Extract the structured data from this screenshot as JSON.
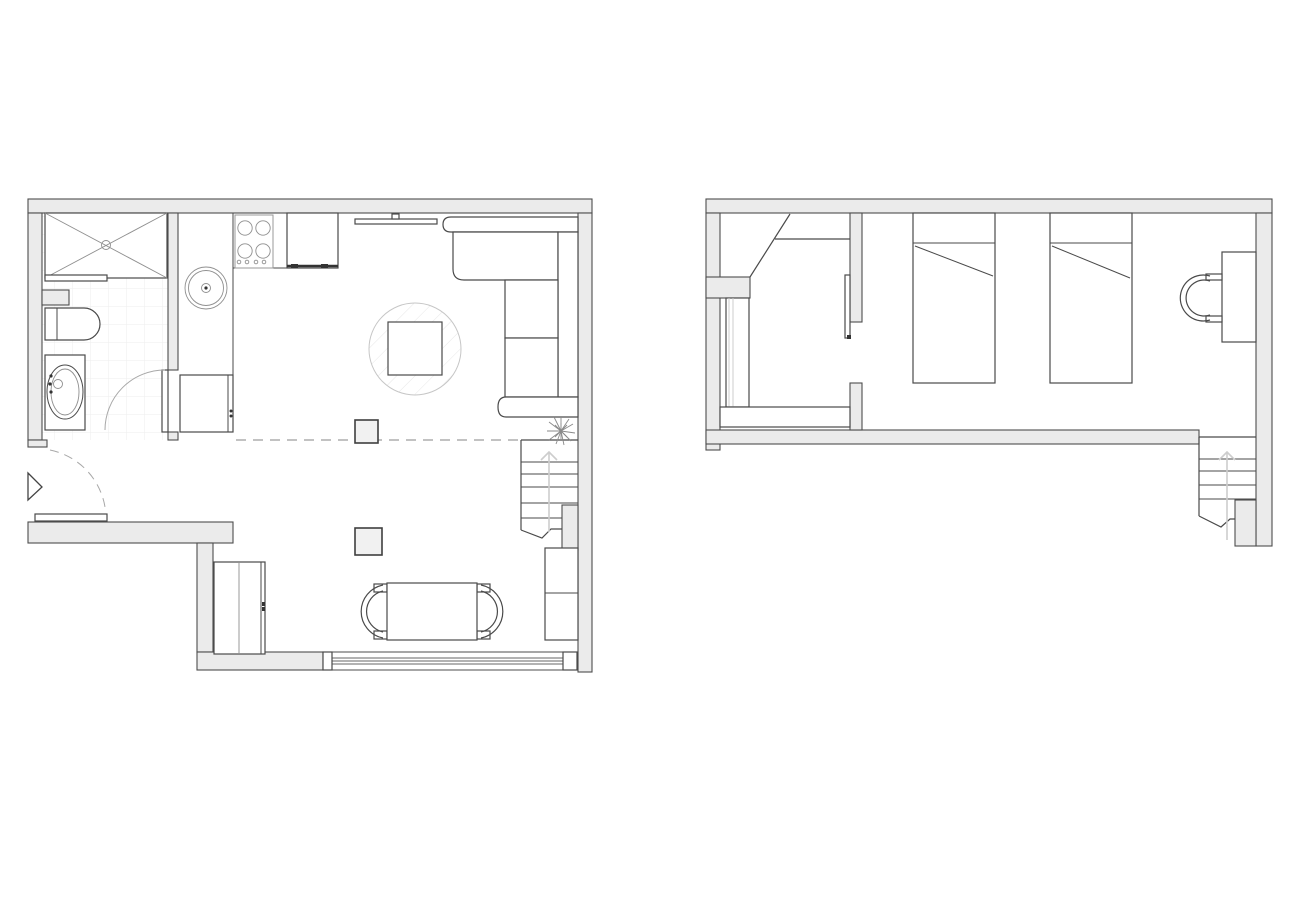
{
  "image": {
    "description": "Black-and-white architectural floor plan of a two-level apartment: ground floor with bathroom, kitchen, living and dining areas on the left; upper floor with closet room and twin bedroom on the right",
    "background": "#ffffff"
  },
  "colors": {
    "wall_fill": "#ebebeb",
    "wall_line": "#4d4d4d",
    "furn_line": "#4a4a4a",
    "light_line": "#8f8f8f",
    "faint_line": "#c9c9c9",
    "dash_line": "#c2c2c2",
    "arrow_line": "#cdcdcd",
    "column_fill": "#f1f1f1",
    "tile_line": "#ededed",
    "hatch_line": "#e7e7e7",
    "bg": "#ffffff"
  },
  "plans": [
    {
      "id": "ground-floor",
      "position": "left",
      "rooms": [
        {
          "name": "bathroom",
          "furniture": [
            "shower-tray-with-cross",
            "shower-screen",
            "toilet",
            "washbasin-vanity",
            "hinged-door-with-swing-arc",
            "tiled-floor"
          ]
        },
        {
          "name": "kitchen",
          "furniture": [
            "l-shaped-counter",
            "round-sink",
            "hob",
            "wall-cabinet",
            "base-cabinet"
          ],
          "hob_burners": 4
        },
        {
          "name": "living-area",
          "furniture": [
            "corner-sofa",
            "round-rug",
            "square-coffee-table",
            "wall-tv",
            "plant",
            "structural-column"
          ]
        },
        {
          "name": "dining-area",
          "furniture": [
            "dining-table",
            "curved-bench-left",
            "curved-bench-right",
            "wardrobe",
            "tall-cabinet",
            "structural-column",
            "full-width-window"
          ]
        },
        {
          "name": "entrance",
          "furniture": [
            "entrance-door-leaf",
            "dashed-swing-arc",
            "entry-direction-triangle"
          ]
        }
      ],
      "stairs": {
        "direction": "up",
        "tread_lines": 5
      },
      "overhead_dashed_line": "mezzanine edge above open space"
    },
    {
      "id": "upper-floor",
      "position": "right",
      "rooms": [
        {
          "name": "closet-room",
          "furniture": [
            "sloped-wall-diagonal",
            "shelf-line",
            "wardrobe",
            "low-shelf-unit",
            "sliding-door-leaf"
          ]
        },
        {
          "name": "twin-bedroom",
          "furniture": [
            "single-bed-1",
            "single-bed-2",
            "desk",
            "curved-chair"
          ],
          "beds": 2
        }
      ],
      "stairs": {
        "direction": "up",
        "tread_lines": 4
      }
    }
  ]
}
